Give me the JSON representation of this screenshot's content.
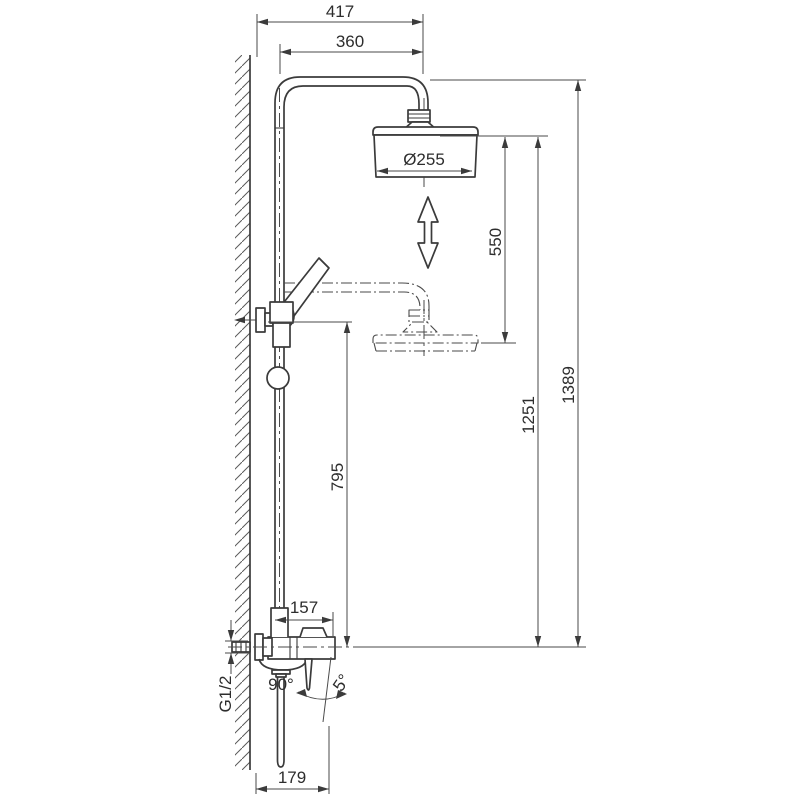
{
  "drawing": {
    "type": "technical dimensional drawing of thermostatic shower column with overhead rain shower, hand shower and wall-mounted mixer",
    "dims": {
      "width_total": "417",
      "arm_reach": "360",
      "head_diameter": "Ø255",
      "head_adjust_range": "550",
      "head_height": "1251",
      "height_total": "1389",
      "bracket_height": "795",
      "body_width": "157",
      "base_reach": "179",
      "thread_size": "G1/2",
      "spout_angle": "90°",
      "handle_tilt": "5°"
    }
  }
}
